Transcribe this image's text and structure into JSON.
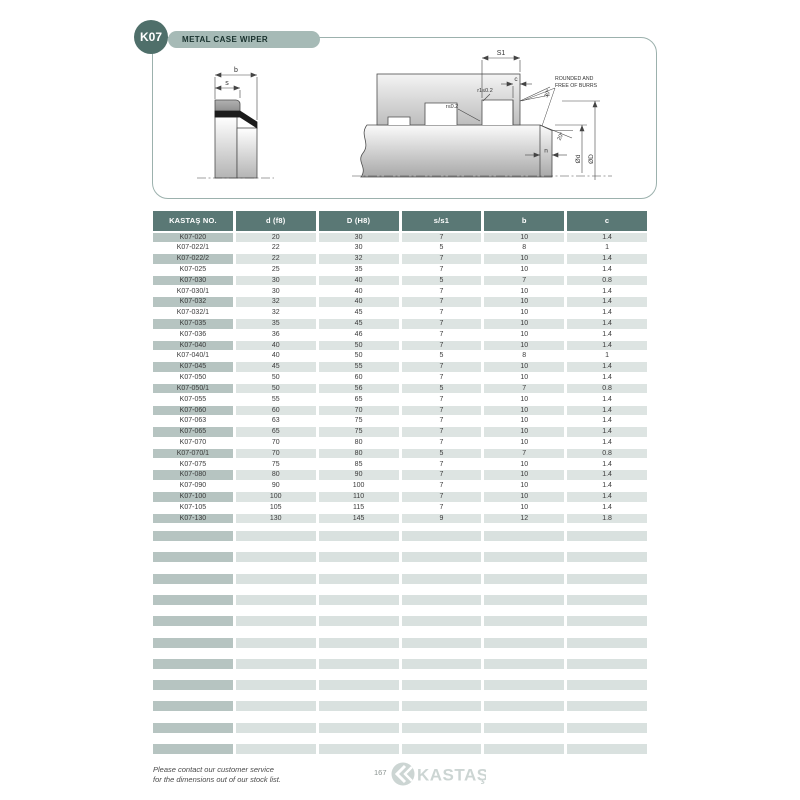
{
  "page": {
    "code": "K07",
    "title": "METAL CASE WIPER",
    "page_number": "167",
    "brand": "KASTAŞ",
    "footer_note_line1": "Please contact our customer service",
    "footer_note_line2": "for the dimensions out of our stock list."
  },
  "diagram": {
    "labels": {
      "b": "b",
      "s": "s",
      "s1": "S1",
      "c": "c",
      "r1": "r1≤0.2",
      "r": "r≤0.2",
      "angle_top": "30°",
      "angle_bottom": "20°",
      "note_line1": "ROUNDED AND",
      "note_line2": "FREE OF BURRS",
      "n": "n",
      "dia_rod": "Ød",
      "dia_bore": "ØD"
    }
  },
  "table": {
    "columns": [
      "KASTAŞ NO.",
      "d (f8)",
      "D (H8)",
      "s/s1",
      "b",
      "c"
    ],
    "rows": [
      [
        "K07-020",
        "20",
        "30",
        "7",
        "10",
        "1.4"
      ],
      [
        "K07-022/1",
        "22",
        "30",
        "5",
        "8",
        "1"
      ],
      [
        "K07-022/2",
        "22",
        "32",
        "7",
        "10",
        "1.4"
      ],
      [
        "K07-025",
        "25",
        "35",
        "7",
        "10",
        "1.4"
      ],
      [
        "K07-030",
        "30",
        "40",
        "5",
        "7",
        "0.8"
      ],
      [
        "K07-030/1",
        "30",
        "40",
        "7",
        "10",
        "1.4"
      ],
      [
        "K07-032",
        "32",
        "40",
        "7",
        "10",
        "1.4"
      ],
      [
        "K07-032/1",
        "32",
        "45",
        "7",
        "10",
        "1.4"
      ],
      [
        "K07-035",
        "35",
        "45",
        "7",
        "10",
        "1.4"
      ],
      [
        "K07-036",
        "36",
        "46",
        "7",
        "10",
        "1.4"
      ],
      [
        "K07-040",
        "40",
        "50",
        "7",
        "10",
        "1.4"
      ],
      [
        "K07-040/1",
        "40",
        "50",
        "5",
        "8",
        "1"
      ],
      [
        "K07-045",
        "45",
        "55",
        "7",
        "10",
        "1.4"
      ],
      [
        "K07-050",
        "50",
        "60",
        "7",
        "10",
        "1.4"
      ],
      [
        "K07-050/1",
        "50",
        "56",
        "5",
        "7",
        "0.8"
      ],
      [
        "K07-055",
        "55",
        "65",
        "7",
        "10",
        "1.4"
      ],
      [
        "K07-060",
        "60",
        "70",
        "7",
        "10",
        "1.4"
      ],
      [
        "K07-063",
        "63",
        "75",
        "7",
        "10",
        "1.4"
      ],
      [
        "K07-065",
        "65",
        "75",
        "7",
        "10",
        "1.4"
      ],
      [
        "K07-070",
        "70",
        "80",
        "7",
        "10",
        "1.4"
      ],
      [
        "K07-070/1",
        "70",
        "80",
        "5",
        "7",
        "0.8"
      ],
      [
        "K07-075",
        "75",
        "85",
        "7",
        "10",
        "1.4"
      ],
      [
        "K07-080",
        "80",
        "90",
        "7",
        "10",
        "1.4"
      ],
      [
        "K07-090",
        "90",
        "100",
        "7",
        "10",
        "1.4"
      ],
      [
        "K07-100",
        "100",
        "110",
        "7",
        "10",
        "1.4"
      ],
      [
        "K07-105",
        "105",
        "115",
        "7",
        "10",
        "1.4"
      ],
      [
        "K07-130",
        "130",
        "145",
        "9",
        "12",
        "1.8"
      ]
    ],
    "empty_row_count": 11
  },
  "colors": {
    "accent_teal": "#4f6f6a",
    "table_header": "#5a7875",
    "pill_bg": "#a6bab6",
    "row_first_col": "#b6c4c1",
    "row_cells": "#dde4e2",
    "panel_border": "#9cb1ad",
    "logo_gray": "#ccd5d3"
  }
}
